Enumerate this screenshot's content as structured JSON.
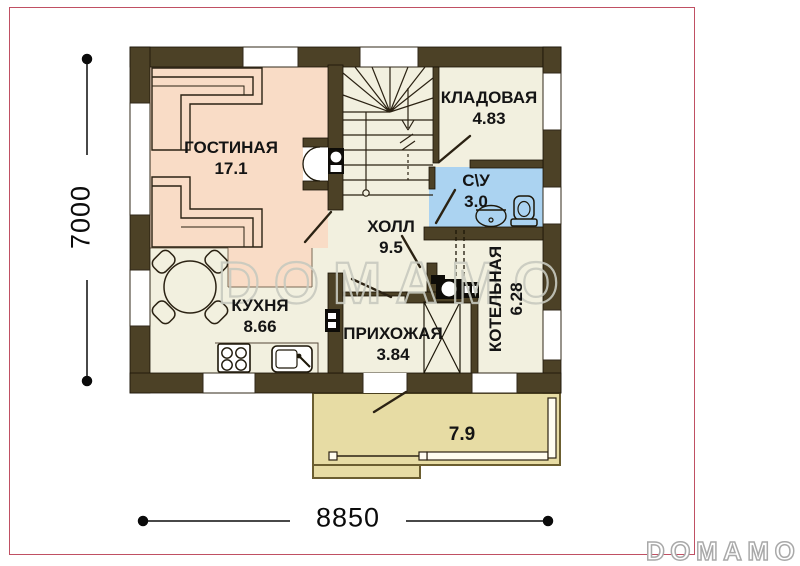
{
  "plan": {
    "rooms": [
      {
        "name": "ГОСТИНАЯ",
        "area": "17.1"
      },
      {
        "name": "КЛАДОВАЯ",
        "area": "4.83"
      },
      {
        "name": "С\\У",
        "area": "3.0"
      },
      {
        "name": "ХОЛЛ",
        "area": "9.5"
      },
      {
        "name": "КУХНЯ",
        "area": "8.66"
      },
      {
        "name": "ПРИХОЖАЯ",
        "area": "3.84"
      },
      {
        "name": "КОТЕЛЬНАЯ",
        "area": "6.28"
      }
    ],
    "terrace_area": "7.9",
    "dimensions": {
      "vertical": "7000",
      "horizontal": "8850"
    },
    "icons": [
      "staircase-icon",
      "fireplace-icon",
      "sofa-icon",
      "dining-table-icon",
      "stove-icon",
      "kitchen-sink-icon",
      "wardrobe-icon",
      "boiler-icon",
      "flue-icon",
      "bathroom-sink-icon",
      "toilet-icon",
      "railing-icon",
      "door-swing-icon",
      "dimension-line"
    ]
  },
  "watermark": {
    "center": "DOMAMO",
    "corner": "DOMAMO"
  },
  "colors": {
    "wall": "#4c4126",
    "living": "#f9dcc6",
    "floor": "#f2f0df",
    "bathroom": "#abd3f1",
    "terrace": "#e7dca4",
    "page_border": "#c05063",
    "watermark": "#c8cabf"
  }
}
